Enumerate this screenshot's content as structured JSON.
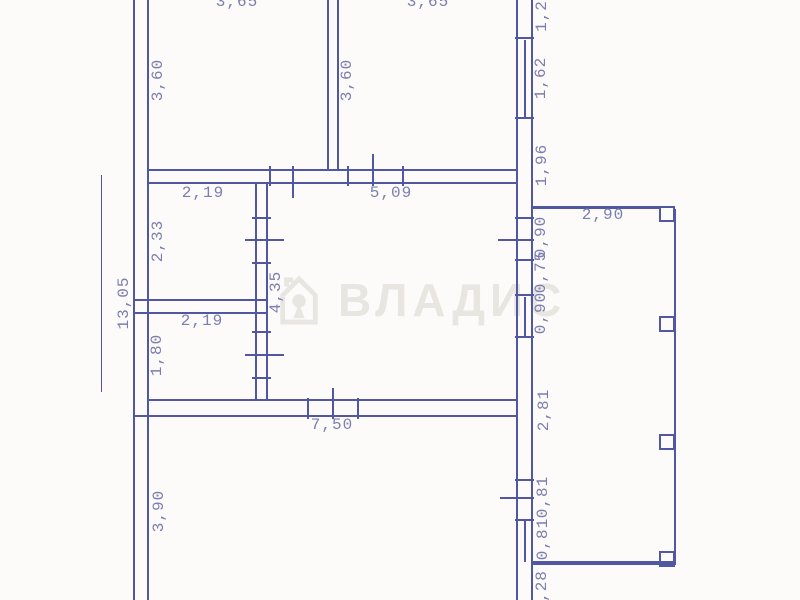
{
  "colors": {
    "background": "#fcfbf9",
    "wall": "#5157a3",
    "dim_text": "#7b7eb0",
    "watermark": "#e9e6e1"
  },
  "watermark": {
    "text": "ВЛАДИС",
    "icon": "house-keyhole-icon"
  },
  "plan": {
    "type": "floor-plan",
    "walls": [
      [
        133,
        0,
        2,
        600
      ],
      [
        147,
        0,
        2,
        600
      ],
      [
        327,
        0,
        2,
        171
      ],
      [
        337,
        0,
        2,
        171
      ],
      [
        516,
        0,
        2,
        600
      ],
      [
        531,
        0,
        2,
        600
      ],
      [
        255,
        183,
        2,
        218
      ],
      [
        266,
        183,
        2,
        218
      ],
      [
        148,
        169,
        370,
        2
      ],
      [
        148,
        182,
        370,
        2
      ],
      [
        135,
        299,
        133,
        2
      ],
      [
        135,
        312,
        133,
        2
      ],
      [
        148,
        399,
        370,
        2
      ],
      [
        135,
        415,
        383,
        2
      ],
      [
        533,
        206,
        128,
        3
      ],
      [
        533,
        561,
        143,
        4
      ],
      [
        674,
        209,
        2,
        355
      ],
      [
        101,
        175,
        1,
        217
      ],
      [
        524,
        40,
        2,
        78
      ],
      [
        524,
        297,
        2,
        40
      ],
      [
        524,
        521,
        2,
        41
      ]
    ],
    "ticks": [
      [
        269,
        166,
        2,
        20
      ],
      [
        292,
        166,
        2,
        32
      ],
      [
        347,
        166,
        2,
        20
      ],
      [
        372,
        154,
        2,
        32
      ],
      [
        402,
        166,
        2,
        20
      ],
      [
        252,
        217,
        19,
        2
      ],
      [
        245,
        239,
        39,
        2
      ],
      [
        252,
        262,
        19,
        2
      ],
      [
        252,
        331,
        19,
        2
      ],
      [
        245,
        354,
        39,
        2
      ],
      [
        252,
        377,
        19,
        2
      ],
      [
        515,
        37,
        19,
        2
      ],
      [
        515,
        117,
        19,
        2
      ],
      [
        515,
        217,
        19,
        2
      ],
      [
        498,
        239,
        36,
        2
      ],
      [
        515,
        259,
        19,
        2
      ],
      [
        515,
        294,
        19,
        2
      ],
      [
        515,
        336,
        19,
        2
      ],
      [
        515,
        479,
        19,
        2
      ],
      [
        500,
        497,
        34,
        2
      ],
      [
        515,
        519,
        19,
        2
      ],
      [
        307,
        398,
        2,
        21
      ],
      [
        357,
        398,
        2,
        21
      ],
      [
        332,
        388,
        2,
        31
      ]
    ],
    "pillars": [
      [
        659,
        206,
        16,
        16
      ],
      [
        659,
        316,
        16,
        16
      ],
      [
        659,
        434,
        16,
        16
      ],
      [
        659,
        551,
        16,
        16
      ]
    ],
    "labels": [
      {
        "t": "3,65",
        "x": 237,
        "y": 2,
        "r": 0
      },
      {
        "t": "3,65",
        "x": 428,
        "y": 2,
        "r": 0
      },
      {
        "t": "3,60",
        "x": 158,
        "y": 80,
        "r": 1
      },
      {
        "t": "3,60",
        "x": 347,
        "y": 80,
        "r": 1
      },
      {
        "t": "1,2",
        "x": 542,
        "y": 16,
        "r": 1
      },
      {
        "t": "1,62",
        "x": 541,
        "y": 78,
        "r": 1
      },
      {
        "t": "1,96",
        "x": 542,
        "y": 165,
        "r": 1
      },
      {
        "t": "2,19",
        "x": 203,
        "y": 193,
        "r": 0
      },
      {
        "t": "5,09",
        "x": 391,
        "y": 193,
        "r": 0
      },
      {
        "t": "13,05",
        "x": 124,
        "y": 303,
        "r": 1
      },
      {
        "t": "2,33",
        "x": 158,
        "y": 241,
        "r": 1
      },
      {
        "t": "4,35",
        "x": 276,
        "y": 292,
        "r": 1
      },
      {
        "t": "2,19",
        "x": 202,
        "y": 321,
        "r": 0
      },
      {
        "t": "1,80",
        "x": 157,
        "y": 355,
        "r": 1
      },
      {
        "t": "2,90",
        "x": 603,
        "y": 215,
        "r": 0
      },
      {
        "t": "0,90",
        "x": 541,
        "y": 237,
        "r": 1
      },
      {
        "t": "0,75",
        "x": 541,
        "y": 272,
        "r": 1
      },
      {
        "t": "0,90",
        "x": 541,
        "y": 313,
        "r": 1
      },
      {
        "t": "2,81",
        "x": 544,
        "y": 410,
        "r": 1
      },
      {
        "t": "0,81",
        "x": 543,
        "y": 497,
        "r": 1
      },
      {
        "t": "0,81",
        "x": 543,
        "y": 539,
        "r": 1
      },
      {
        "t": "7,50",
        "x": 332,
        "y": 425,
        "r": 0
      },
      {
        "t": "3,90",
        "x": 159,
        "y": 511,
        "r": 1
      },
      {
        "t": ",28",
        "x": 542,
        "y": 586,
        "r": 1
      }
    ]
  }
}
